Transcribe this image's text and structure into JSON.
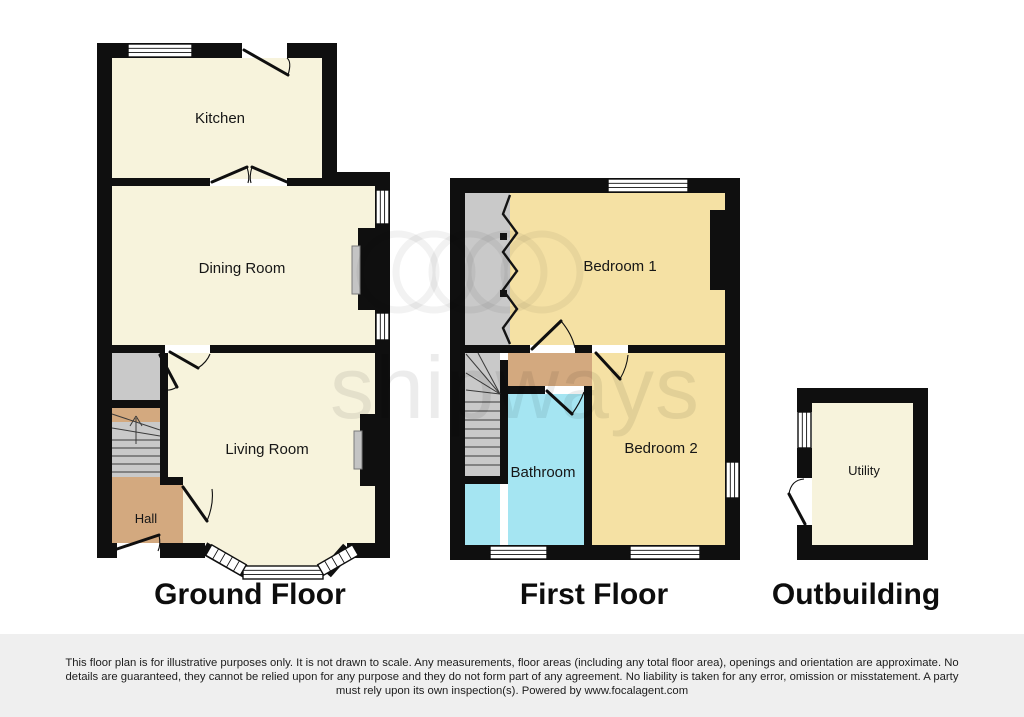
{
  "watermark": {
    "text": "shipways"
  },
  "floors": [
    {
      "title": "Ground Floor",
      "rooms": [
        {
          "label": "Kitchen"
        },
        {
          "label": "Dining Room"
        },
        {
          "label": "Living Room"
        },
        {
          "label": "Hall"
        }
      ]
    },
    {
      "title": "First Floor",
      "rooms": [
        {
          "label": "Bedroom 1"
        },
        {
          "label": "Bedroom 2"
        },
        {
          "label": "Bathroom"
        }
      ]
    },
    {
      "title": "Outbuilding",
      "rooms": [
        {
          "label": "Utility"
        }
      ]
    }
  ],
  "colors": {
    "wall": "#0f0f0f",
    "room_cream": "#f7f3dc",
    "room_yellow": "#f5e1a4",
    "room_cyan": "#a5e5f2",
    "room_tan": "#d3a97f",
    "stairs_gray": "#c9c9c9",
    "fireplace_gray": "#c4c4c4",
    "footer_background": "#efefef"
  },
  "disclaimer": {
    "lines": [
      "This floor plan is for illustrative purposes only. It is not drawn to scale. Any measurements, floor areas (including any total floor area), openings and orientation are approximate. No",
      "details are guaranteed, they cannot be relied upon for any purpose and they do not form part of any agreement. No liability is taken for any error, omission or misstatement. A party",
      "must rely upon its own inspection(s). Powered by www.focalagent.com"
    ]
  }
}
